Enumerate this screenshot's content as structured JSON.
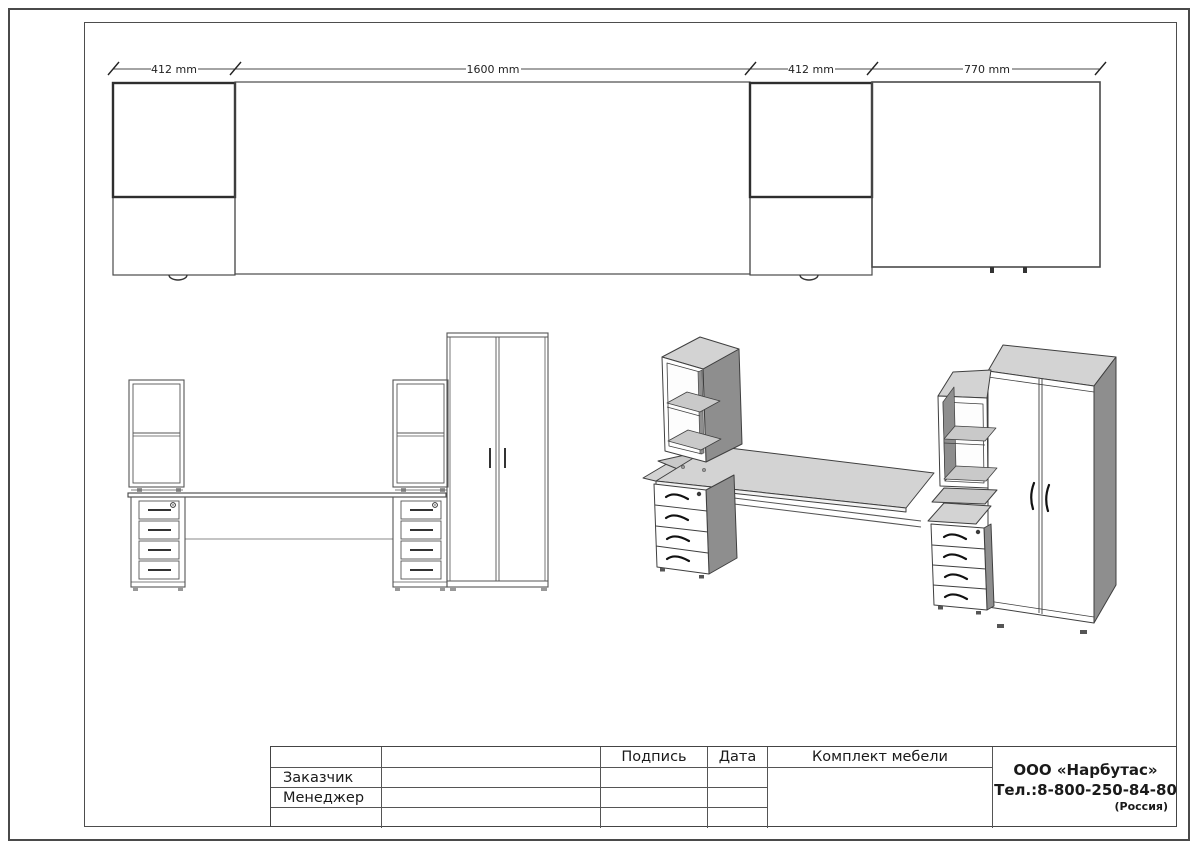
{
  "drawing": {
    "dimensions": {
      "d1": "412 mm",
      "d2": "1600 mm",
      "d3": "412 mm",
      "d4": "770 mm"
    },
    "title_block": {
      "headers": {
        "signature": "Подпись",
        "date": "Дата",
        "set": "Комплект мебели"
      },
      "rows": {
        "customer": "Заказчик",
        "manager": "Менеджер"
      },
      "company": {
        "name": "ООО «Нарбутас»",
        "phone": "Тел.:8-800-250-84-80",
        "country": "(Россия)"
      }
    },
    "colors": {
      "line": "#4a4a4a",
      "dark_line": "#2e2e2e",
      "top_face": "#d3d3d3",
      "side_face": "#8e8e8e",
      "shelf_face": "#c9c9c9"
    }
  }
}
